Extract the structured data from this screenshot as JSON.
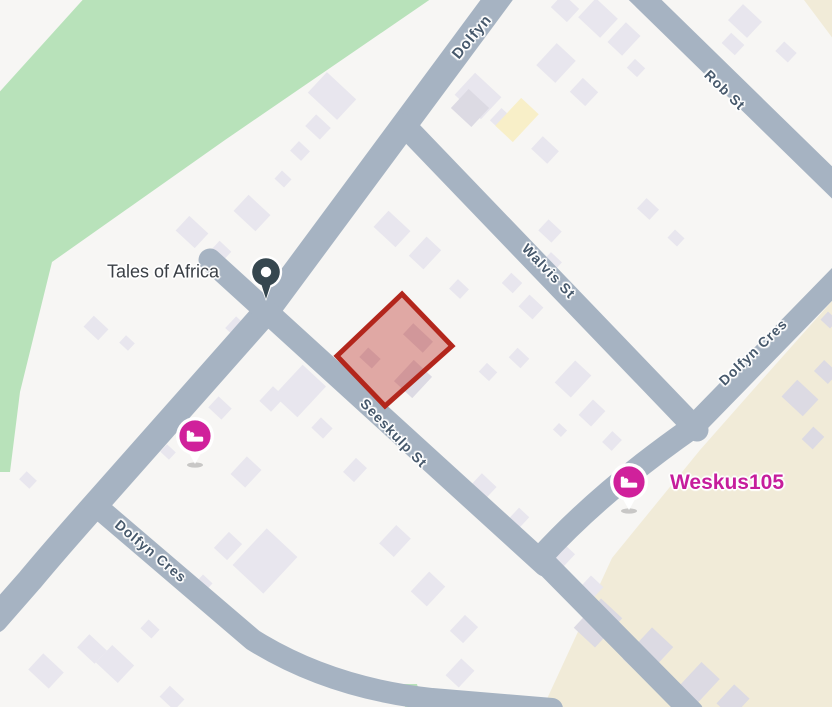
{
  "map": {
    "colors": {
      "background": "#f7f6f4",
      "road": "#a6b3c2",
      "park": "#b8e2ba",
      "sand": "#f1ebd8",
      "building": "#e8e6ee",
      "building_dark": "#dcdae3",
      "building_yellow": "#f8efc8",
      "street_label": "#46586b",
      "poi_pin": "#36474f",
      "lodging_pink": "#d0219b",
      "parcel_stroke": "#b3261c",
      "parcel_fill": "rgba(193,60,52,0.42)",
      "tales_label_color": "#3a3f45",
      "weskus_label_color": "#c61d9c"
    },
    "roads": [
      {
        "id": "dolfyn-st",
        "d": "M 504 -10 L 265 313 L 95 505 Q 55 550 30 580 L -5 620",
        "w": 26
      },
      {
        "id": "seeskulp-st",
        "d": "M 210 260 L 545 565",
        "w": 23
      },
      {
        "id": "walvis-st",
        "d": "M 404 125 L 697 430",
        "w": 23
      },
      {
        "id": "rob-st",
        "d": "M 635 -10 L 848 198",
        "w": 23
      },
      {
        "id": "dolfyn-cres-right",
        "d": "M 848 268 L 693 427 Q 600 492 540 558 L 692 712",
        "w": 23
      },
      {
        "id": "dolfyn-cres-left",
        "d": "M 95 505 L 253 640 Q 330 688 432 699 L 552 709",
        "w": 22
      }
    ],
    "street_labels": [
      {
        "text": "Dolfyn",
        "x": 472,
        "y": 37,
        "rot": -50,
        "size": 15
      },
      {
        "text": "Rob St",
        "x": 725,
        "y": 90,
        "rot": 44,
        "size": 14
      },
      {
        "text": "Walvis St",
        "x": 549,
        "y": 271,
        "rot": 46,
        "size": 14
      },
      {
        "text": "Dolfyn Cres",
        "x": 753,
        "y": 352,
        "rot": -44,
        "size": 14
      },
      {
        "text": "Seeskulp St",
        "x": 394,
        "y": 433,
        "rot": 46,
        "size": 14
      },
      {
        "text": "Dolfyn Cres",
        "x": 151,
        "y": 551,
        "rot": 40,
        "size": 14
      }
    ],
    "patches": {
      "park": [
        [
          88,
          -6
        ],
        [
          438,
          -6
        ],
        [
          225,
          140
        ],
        [
          52,
          262
        ],
        [
          20,
          392
        ],
        [
          10,
          472
        ],
        [
          -6,
          472
        ],
        [
          -6,
          98
        ]
      ],
      "park_strip": [
        [
          399,
          684
        ],
        [
          417,
          684
        ],
        [
          424,
          710
        ],
        [
          406,
          710
        ]
      ],
      "sand": [
        [
          840,
          292
        ],
        [
          760,
          382
        ],
        [
          700,
          450
        ],
        [
          612,
          558
        ],
        [
          540,
          714
        ],
        [
          840,
          714
        ]
      ],
      "sand_corner": [
        [
          798,
          -8
        ],
        [
          840,
          -8
        ],
        [
          840,
          48
        ]
      ]
    },
    "parcel": {
      "points": [
        [
          402,
          294
        ],
        [
          452,
          346
        ],
        [
          385,
          406
        ],
        [
          337,
          356
        ]
      ],
      "stroke_width": 5
    },
    "buildings": [
      [
        332,
        96,
        40,
        28,
        43,
        0
      ],
      [
        318,
        127,
        20,
        16,
        43,
        0
      ],
      [
        300,
        151,
        15,
        13,
        43,
        0
      ],
      [
        283,
        179,
        13,
        11,
        43,
        0
      ],
      [
        252,
        213,
        30,
        22,
        43,
        0
      ],
      [
        192,
        232,
        26,
        20,
        43,
        0
      ],
      [
        221,
        251,
        16,
        13,
        43,
        0
      ],
      [
        96,
        328,
        20,
        15,
        43,
        0
      ],
      [
        127,
        343,
        12,
        10,
        43,
        0
      ],
      [
        238,
        329,
        20,
        16,
        43,
        0
      ],
      [
        300,
        391,
        32,
        42,
        43,
        0
      ],
      [
        272,
        399,
        16,
        20,
        43,
        0
      ],
      [
        322,
        428,
        16,
        14,
        43,
        0
      ],
      [
        220,
        408,
        18,
        15,
        43,
        0
      ],
      [
        168,
        452,
        12,
        10,
        43,
        0
      ],
      [
        246,
        472,
        20,
        24,
        43,
        0
      ],
      [
        265,
        561,
        42,
        50,
        43,
        0
      ],
      [
        228,
        546,
        18,
        22,
        43,
        0
      ],
      [
        204,
        583,
        13,
        11,
        43,
        0
      ],
      [
        150,
        629,
        15,
        12,
        43,
        0
      ],
      [
        92,
        649,
        24,
        18,
        43,
        0
      ],
      [
        46,
        671,
        28,
        22,
        43,
        0
      ],
      [
        115,
        664,
        30,
        24,
        43,
        0
      ],
      [
        28,
        480,
        14,
        11,
        43,
        0
      ],
      [
        172,
        698,
        20,
        15,
        43,
        0
      ],
      [
        392,
        229,
        30,
        22,
        43,
        0
      ],
      [
        425,
        253,
        20,
        26,
        43,
        0
      ],
      [
        459,
        289,
        15,
        13,
        43,
        0
      ],
      [
        370,
        358,
        17,
        13,
        43,
        1
      ],
      [
        418,
        338,
        27,
        15,
        43,
        1
      ],
      [
        413,
        379,
        25,
        29,
        43,
        1
      ],
      [
        488,
        372,
        14,
        12,
        43,
        0
      ],
      [
        519,
        358,
        16,
        13,
        43,
        0
      ],
      [
        573,
        379,
        22,
        30,
        43,
        0
      ],
      [
        592,
        413,
        17,
        21,
        43,
        0
      ],
      [
        612,
        441,
        13,
        15,
        43,
        0
      ],
      [
        560,
        430,
        11,
        9,
        43,
        0
      ],
      [
        480,
        490,
        20,
        27,
        43,
        0
      ],
      [
        518,
        519,
        14,
        18,
        43,
        0
      ],
      [
        556,
        557,
        24,
        30,
        43,
        0
      ],
      [
        590,
        589,
        17,
        21,
        43,
        0
      ],
      [
        355,
        470,
        15,
        19,
        43,
        0
      ],
      [
        395,
        541,
        20,
        25,
        43,
        0
      ],
      [
        428,
        589,
        22,
        27,
        43,
        0
      ],
      [
        464,
        629,
        18,
        22,
        43,
        0
      ],
      [
        460,
        673,
        18,
        23,
        43,
        0
      ],
      [
        478,
        96,
        36,
        30,
        43,
        0
      ],
      [
        503,
        121,
        20,
        17,
        43,
        0
      ],
      [
        565,
        8,
        22,
        18,
        43,
        0
      ],
      [
        598,
        18,
        30,
        26,
        43,
        0
      ],
      [
        556,
        63,
        26,
        30,
        43,
        0
      ],
      [
        584,
        92,
        21,
        19,
        43,
        0
      ],
      [
        624,
        39,
        20,
        27,
        43,
        0
      ],
      [
        636,
        68,
        14,
        12,
        43,
        0
      ],
      [
        545,
        150,
        22,
        17,
        43,
        0
      ],
      [
        470,
        108,
        28,
        26,
        43,
        1
      ],
      [
        517,
        120,
        24,
        38,
        43,
        2
      ],
      [
        550,
        231,
        18,
        15,
        43,
        0
      ],
      [
        552,
        262,
        15,
        13,
        43,
        0
      ],
      [
        512,
        283,
        15,
        14,
        43,
        0
      ],
      [
        531,
        307,
        19,
        16,
        43,
        0
      ],
      [
        648,
        209,
        17,
        14,
        43,
        0
      ],
      [
        676,
        238,
        13,
        11,
        43,
        0
      ],
      [
        745,
        21,
        26,
        22,
        43,
        0
      ],
      [
        733,
        44,
        18,
        14,
        43,
        0
      ],
      [
        786,
        52,
        17,
        13,
        43,
        0
      ],
      [
        598,
        623,
        29,
        40,
        43,
        1
      ],
      [
        648,
        653,
        29,
        43,
        43,
        1
      ],
      [
        699,
        683,
        25,
        34,
        43,
        1
      ],
      [
        733,
        701,
        21,
        26,
        43,
        1
      ],
      [
        800,
        398,
        29,
        23,
        43,
        1
      ],
      [
        826,
        372,
        19,
        15,
        43,
        1
      ],
      [
        813,
        438,
        15,
        17,
        43,
        1
      ],
      [
        829,
        320,
        13,
        11,
        43,
        1
      ]
    ],
    "pois": {
      "tales": {
        "label": "Tales of Africa",
        "label_x": 163,
        "label_y": 272,
        "label_size": 18,
        "pin_x": 266,
        "pin_y": 272
      },
      "weskus": {
        "label": "Weskus105",
        "label_x": 727,
        "label_y": 483,
        "label_size": 21,
        "pin_x": 629,
        "pin_y": 482
      },
      "lodging_west": {
        "pin_x": 195,
        "pin_y": 436
      }
    }
  }
}
